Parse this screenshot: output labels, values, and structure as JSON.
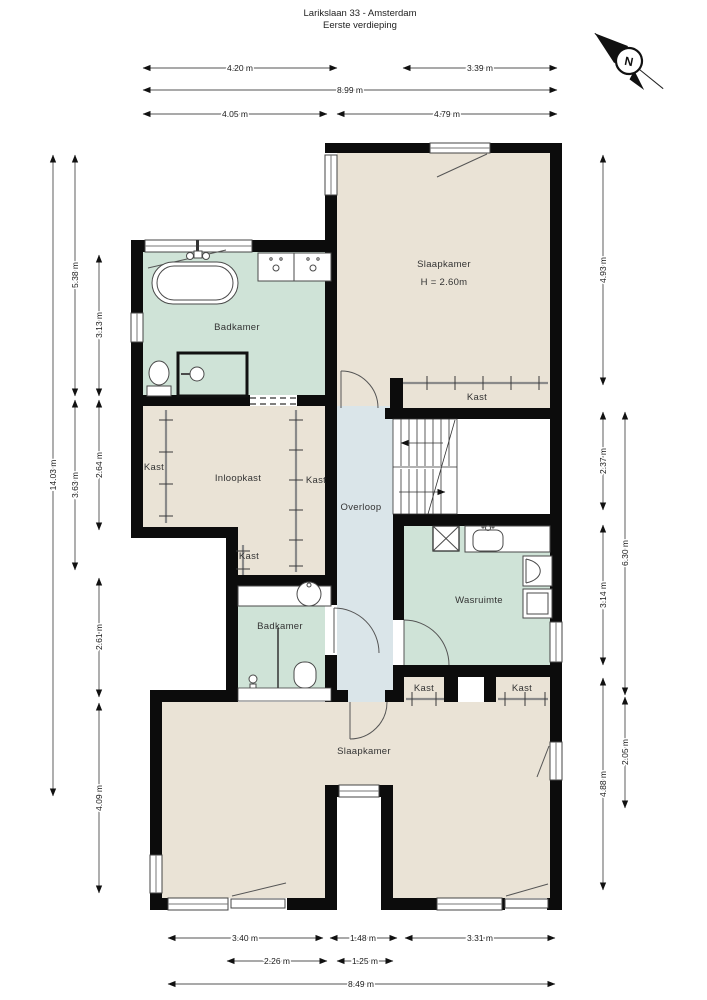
{
  "title": {
    "line1": "Larikslaan 33 - Amsterdam",
    "line2": "Eerste verdieping"
  },
  "compass": {
    "north_label": "N"
  },
  "rooms": {
    "badkamer_top": "Badkamer",
    "slaapkamer_top": "Slaapkamer",
    "slaapkamer_top_height": "H = 2.60m",
    "kast_slaapkamer": "Kast",
    "kast_left": "Kast",
    "inloopkast": "Inloopkast",
    "kast_mid": "Kast",
    "kast_klein": "Kast",
    "overloop": "Overloop",
    "wasruimte": "Wasruimte",
    "badkamer_onder": "Badkamer",
    "kast_onder_links": "Kast",
    "kast_onder_rechts": "Kast",
    "slaapkamer_onder": "Slaapkamer"
  },
  "dimensions": {
    "top": [
      "4.20 m",
      "3.39 m",
      "8.99 m",
      "4.05 m",
      "4.79 m"
    ],
    "bottom": [
      "3.40 m",
      "1.48 m",
      "3.31 m",
      "2.26 m",
      "1.25 m",
      "8.49 m"
    ],
    "left": [
      "14.03 m",
      "5.38 m",
      "3.63 m",
      "3.13 m",
      "2.64 m",
      "2.61 m",
      "4.09 m"
    ],
    "right": [
      "4.93 m",
      "2.37 m",
      "3.14 m",
      "4.88 m",
      "6.30 m",
      "2.05 m"
    ]
  },
  "colors": {
    "wall": "#0c0c0c",
    "floor_room": "#eae3d6",
    "floor_bath": "#cfe3d7",
    "floor_hall": "#dae5e9",
    "line": "#444444"
  }
}
